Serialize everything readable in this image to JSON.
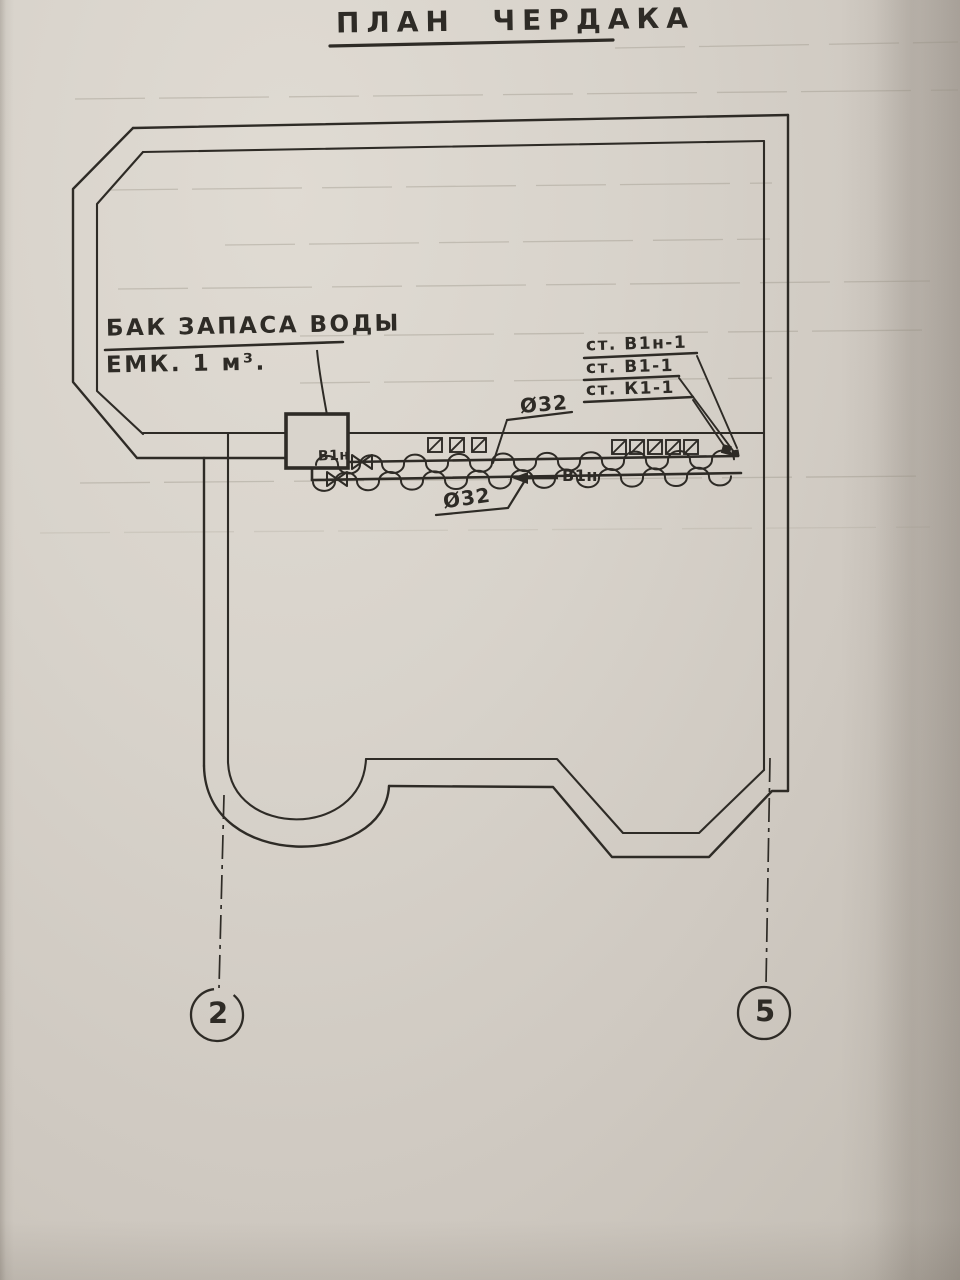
{
  "title": "ПЛАН ЧЕРДАКА",
  "labels": {
    "tank_line1": "БАК ЗАПАСА ВОДЫ",
    "tank_line2": "ЕМК. 1 м³.",
    "dia_top": "Ø32",
    "dia_bottom": "Ø32",
    "pipe_flow": "В1н",
    "pipe_valve": "В1н"
  },
  "stacks": [
    {
      "label": "ст. В1н-1"
    },
    {
      "label": "ст. В1-1"
    },
    {
      "label": "ст. К1-1"
    }
  ],
  "axes": [
    {
      "number": "2"
    },
    {
      "number": "5"
    }
  ],
  "colors": {
    "ink": "#2e2b26",
    "paper": "#d4cfc7",
    "faint": "#968f82"
  }
}
